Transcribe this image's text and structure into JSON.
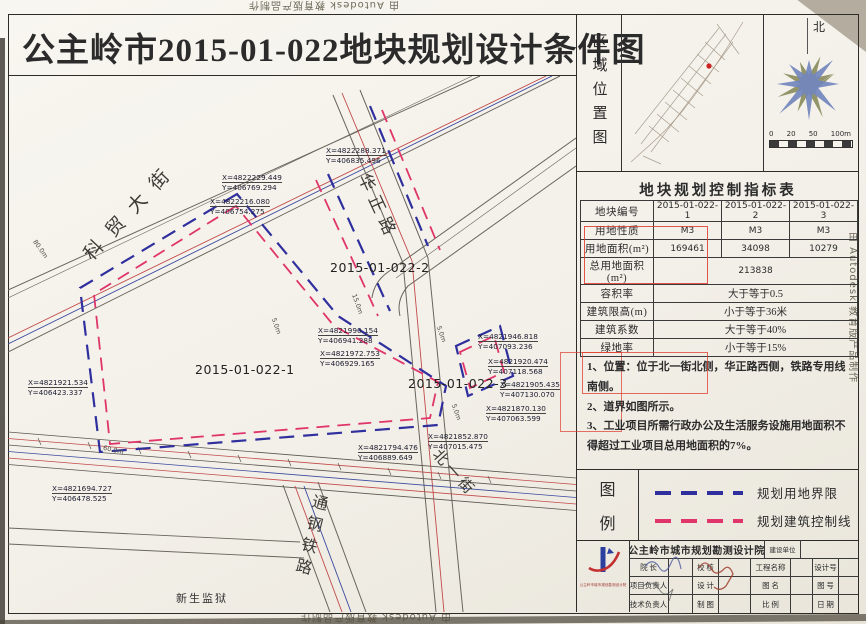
{
  "title": "公主岭市2015-01-022地块规划设计条件图",
  "watermark": "由 Autodesk 教育版产品制作",
  "region_panel": {
    "label": "区域位置图",
    "north": "北",
    "scale_labels": [
      "0",
      "20",
      "50",
      "100m"
    ]
  },
  "indicator_table": {
    "title": "地块规划控制指标表",
    "header": {
      "label": "地块编号",
      "cols": [
        "2015-01-022-1",
        "2015-01-022-2",
        "2015-01-022-3"
      ]
    },
    "rows": [
      {
        "label": "用地性质",
        "values": [
          "M3",
          "M3",
          "M3"
        ]
      },
      {
        "label": "用地面积(m²)",
        "values": [
          "169461",
          "34098",
          "10279"
        ]
      }
    ],
    "merged": [
      {
        "label": "总用地面积(m²)",
        "value": "213838"
      },
      {
        "label": "容积率",
        "value": "大于等于0.5"
      },
      {
        "label": "建筑限高(m)",
        "value": "小于等于36米"
      },
      {
        "label": "建筑系数",
        "value": "大于等于40%"
      },
      {
        "label": "绿地率",
        "value": "小于等于15%"
      }
    ]
  },
  "notes": {
    "lines": [
      "1、位置：位于北一街北侧，华正路西侧，铁路专用线南侧。",
      "2、道界如图所示。",
      "3、工业项目所需行政办公及生活服务设施用地面积不得超过工业项目总用地面积的7%。"
    ]
  },
  "legend": {
    "chars": [
      "图",
      "例"
    ],
    "items": [
      {
        "name": "规划用地界限",
        "color": "#2f2f9e"
      },
      {
        "name": "规划建筑控制线",
        "color": "#e0356a"
      }
    ]
  },
  "title_block": {
    "institute": "公主岭市城市规划勘测设计院",
    "client_label": "建设单位",
    "rows": [
      [
        "院 长",
        "校 核",
        "工程名称",
        "设计号"
      ],
      [
        "项目负责人",
        "设 计",
        "图 名",
        "图 号"
      ],
      [
        "技术负责人",
        "制 图",
        "比 例",
        "日 期"
      ]
    ]
  },
  "map": {
    "plots": [
      "2015-01-022-1",
      "2015-01-022-2",
      "2015-01-022-3"
    ],
    "roads": {
      "kemao": "科贸大街",
      "huazheng": "华正路",
      "beiyi": "北一街",
      "tonggang": "通钢铁路"
    },
    "place": "新生监狱",
    "coords": [
      {
        "x": "X=4822288.371",
        "y": "Y=406835.496"
      },
      {
        "x": "X=4822229.449",
        "y": "Y=406769.294"
      },
      {
        "x": "X=4822216.080",
        "y": "Y=406754.275"
      },
      {
        "x": "X=4821990.154",
        "y": "Y=406941.288"
      },
      {
        "x": "X=4821972.753",
        "y": "Y=406929.165"
      },
      {
        "x": "X=4821946.818",
        "y": "Y=407093.236"
      },
      {
        "x": "X=4821920.474",
        "y": "Y=407118.568"
      },
      {
        "x": "X=4821905.435",
        "y": "Y=407130.070"
      },
      {
        "x": "X=4821870.130",
        "y": "Y=407063.599"
      },
      {
        "x": "X=4821852.870",
        "y": "Y=407015.475"
      },
      {
        "x": "X=4821794.476",
        "y": "Y=406889.649"
      },
      {
        "x": "X=4821921.534",
        "y": "Y=406423.337"
      },
      {
        "x": "X=4821694.727",
        "y": "Y=406478.525"
      }
    ],
    "distances": [
      "5.0m",
      "15.0m",
      "5.0m",
      "5.0m",
      "60.0m",
      "80.0m"
    ]
  },
  "colors": {
    "boundary_blue": "#2f2f9e",
    "control_red": "#e0356a",
    "annotation_red": "#e0392c"
  }
}
